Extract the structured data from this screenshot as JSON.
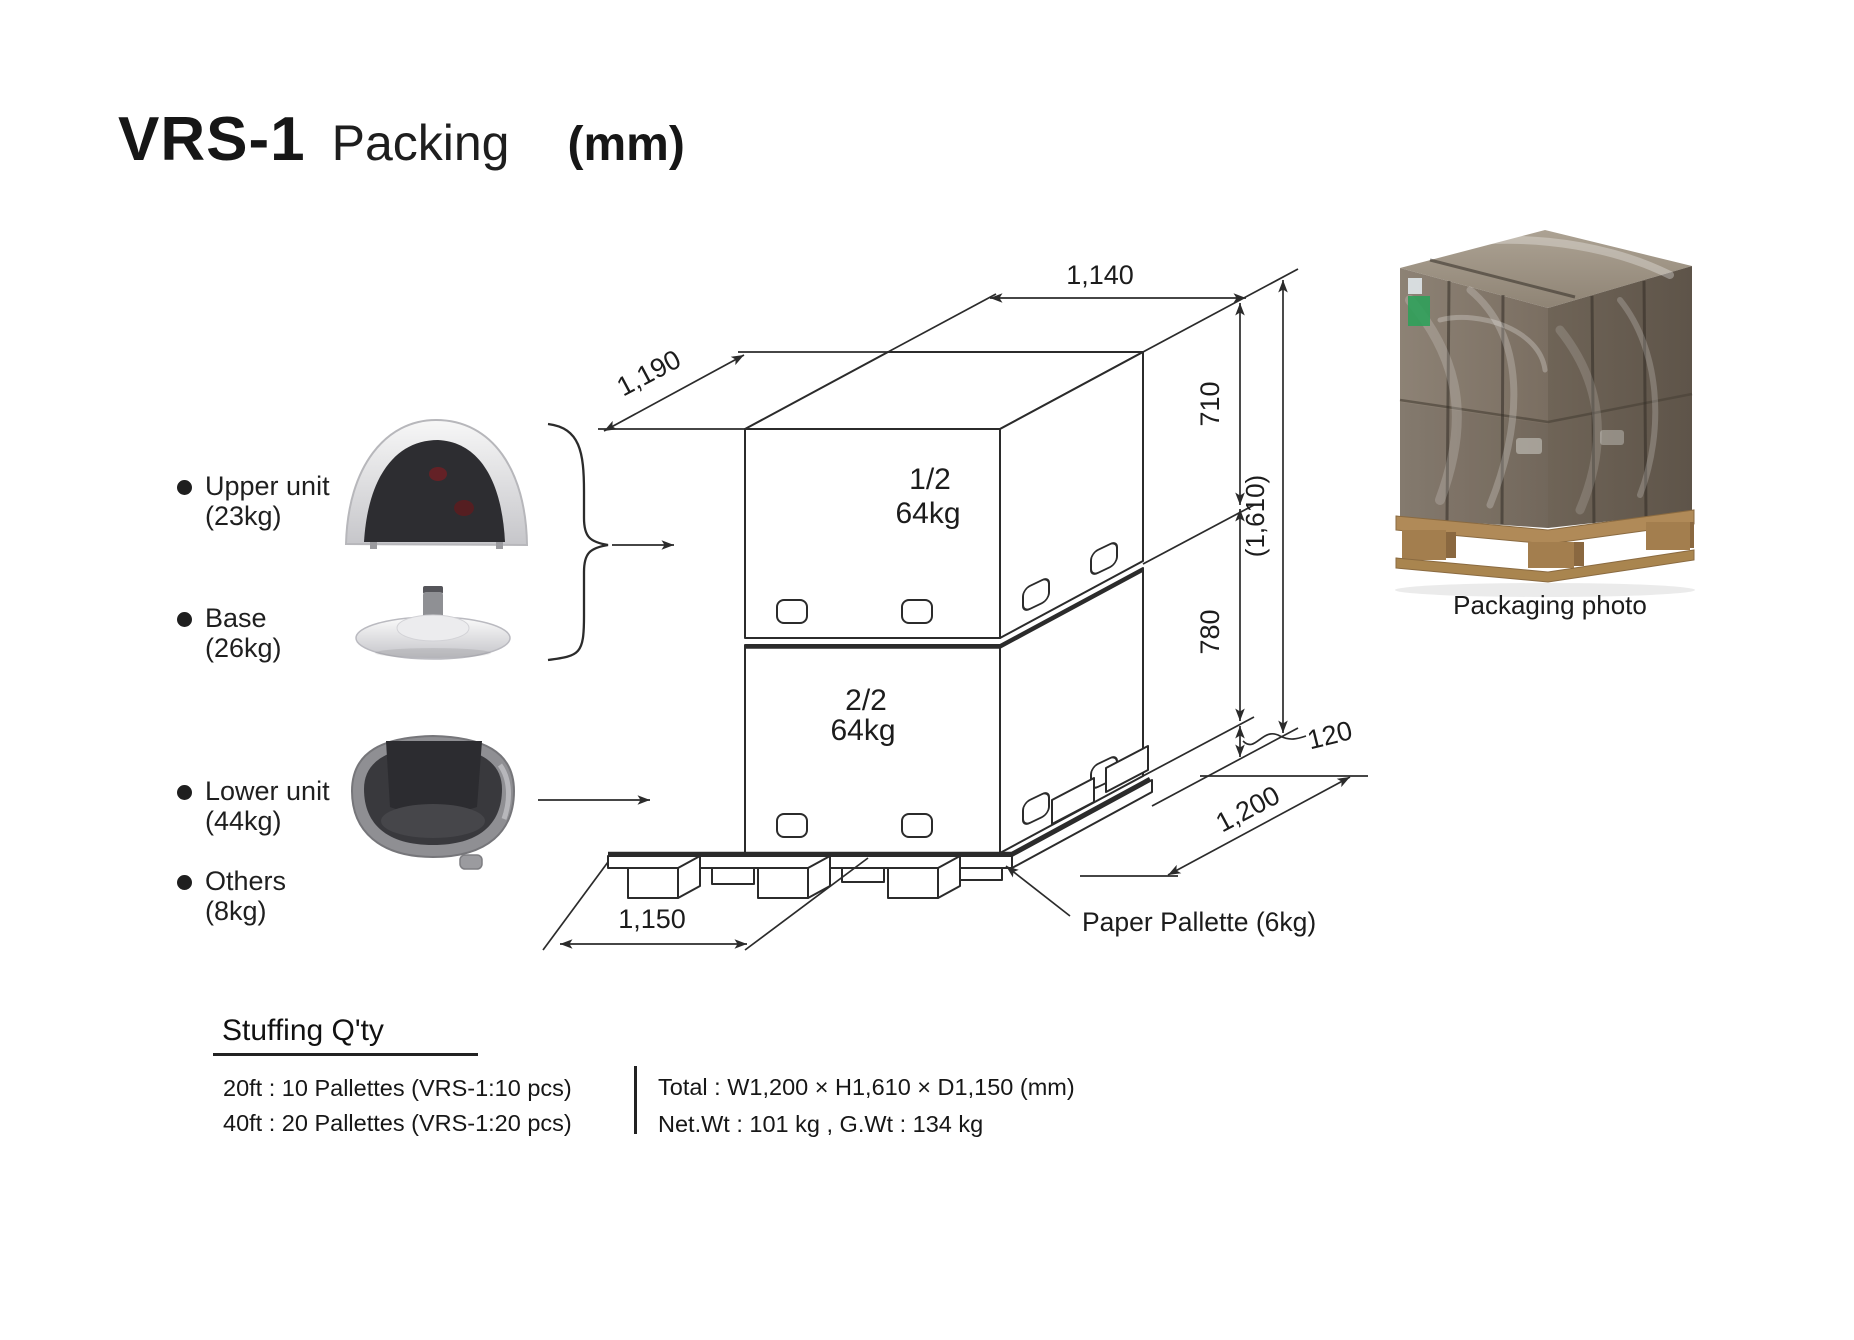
{
  "title": {
    "model": "VRS-1",
    "subtitle": "Packing",
    "unit": "(mm)"
  },
  "components": {
    "items": [
      {
        "label": "Upper unit",
        "weight": "(23kg)"
      },
      {
        "label": "Base",
        "weight": "(26kg)"
      },
      {
        "label": "Lower unit",
        "weight": "(44kg)"
      },
      {
        "label": "Others",
        "weight": "(8kg)"
      }
    ]
  },
  "diagram": {
    "boxes": {
      "upper_seq": "1/2",
      "upper_weight": "64kg",
      "lower_seq": "2/2",
      "lower_weight": "64kg"
    },
    "dimensions": {
      "top_width": "1,140",
      "top_depth": "1,190",
      "upper_box_height": "710",
      "lower_box_height": "780",
      "total_height": "(1,610)",
      "pallet_height": "120",
      "pallet_depth": "1,200",
      "pallet_width": "1,150"
    },
    "pallet_label": "Paper Pallette (6kg)"
  },
  "photo": {
    "caption": "Packaging photo"
  },
  "stuffing": {
    "heading": "Stuffing Q'ty",
    "container_rows": [
      "20ft : 10 Pallettes (VRS-1:10 pcs)",
      "40ft : 20 Pallettes (VRS-1:20 pcs)"
    ],
    "total_rows": [
      "Total : W1,200 × H1,610 × D1,150 (mm)",
      "Net.Wt : 101 kg , G.Wt : 134 kg"
    ]
  },
  "colors": {
    "line": "#2b2b2b",
    "text": "#1c1c1c"
  }
}
